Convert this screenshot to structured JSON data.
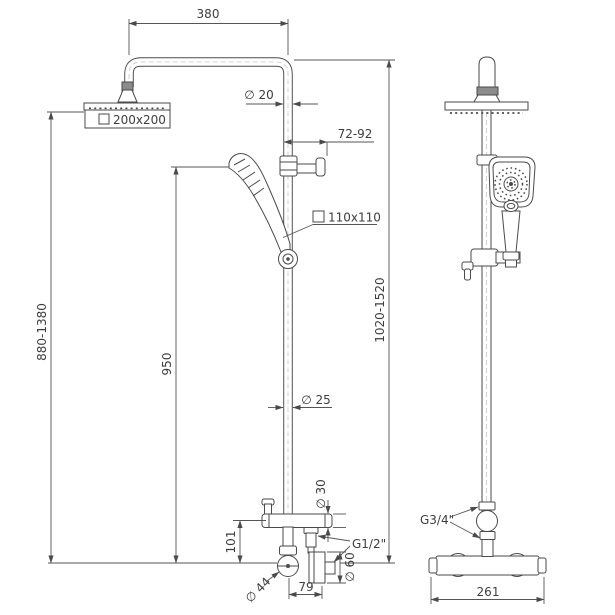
{
  "drawing": {
    "description": "Thermostatic shower column technical drawing with front and side views",
    "line_color": "#4a4a4a",
    "text_color": "#3d3d3d",
    "background": "#ffffff",
    "front_view": {
      "dim_arm_width": "380",
      "dia_arm_pipe": "∅ 20",
      "head_size": "200x200",
      "dim_bracket_reach": "72-92",
      "hand_shower_size": "110x110",
      "dim_height_adjustable": "880-1380",
      "dim_column": "950",
      "dim_overall_height": "1020-1520",
      "dia_column_pipe": "∅ 25",
      "dia_tee": "∅ 30",
      "dim_tee_to_valve": "101",
      "dia_handle": "∅ 44",
      "dim_outlet_offset": "79",
      "dia_escutcheon": "∅ 60",
      "thread_hose_outlet": "G1/2\""
    },
    "side_view": {
      "thread_inlet": "G3/4\"",
      "dim_mixer_width": "261"
    }
  }
}
